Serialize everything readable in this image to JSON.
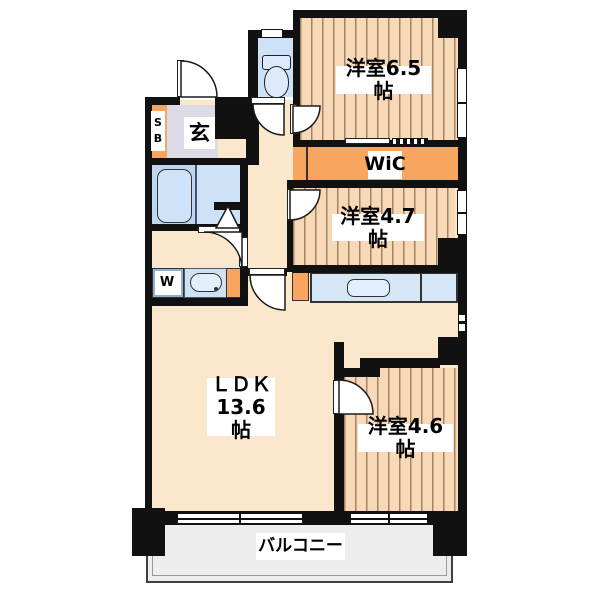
{
  "floorplan": {
    "rooms": {
      "bedroom_top": {
        "label": "洋室6.5帖"
      },
      "wic": {
        "label": "WiC"
      },
      "bedroom_mid": {
        "label": "洋室4.7帖"
      },
      "bedroom_bottom": {
        "label": "洋室4.6帖"
      },
      "ldk": {
        "name": "ＬＤＫ",
        "size": "13.6帖"
      },
      "balcony": {
        "label": "バルコニー"
      },
      "entrance": {
        "label": "玄"
      },
      "shoe_box": {
        "label": "SB"
      },
      "washer": {
        "label": "W"
      }
    },
    "colors": {
      "wall": "#111111",
      "wood_floor": "#f7d9b8",
      "orange_accent": "#f8a55f",
      "beige_floor": "#fbe7cc",
      "water_blue": "#cde2f6",
      "entrance_gray": "#dcdbe5",
      "balcony_gray": "#ededed"
    }
  }
}
